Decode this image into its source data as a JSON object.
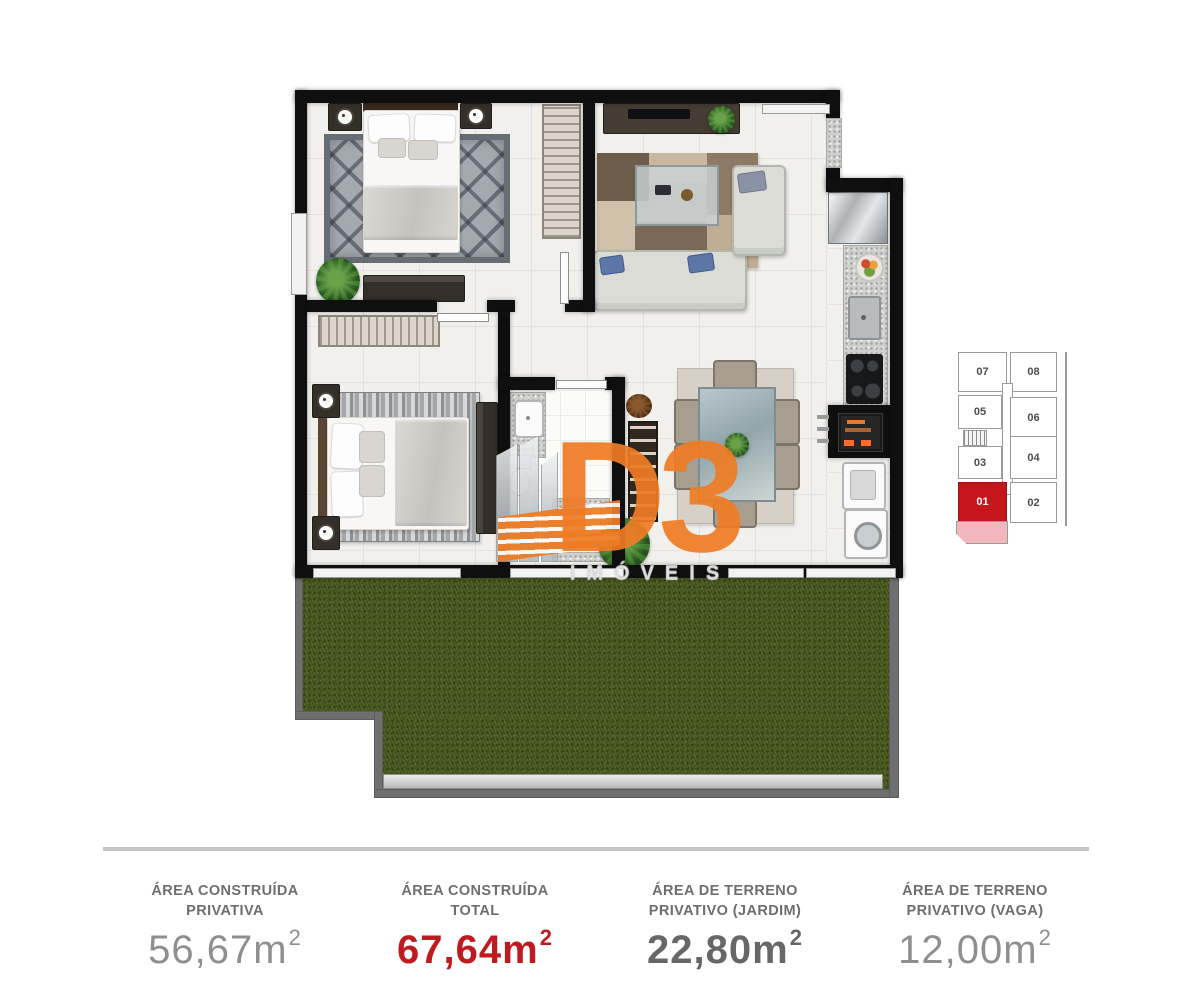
{
  "watermark": {
    "brand": "D3",
    "subtitle": "IMÓVEIS",
    "orange": "#ee7c24"
  },
  "keyplan": {
    "units": [
      {
        "label": "07",
        "highlighted": false
      },
      {
        "label": "08",
        "highlighted": false
      },
      {
        "label": "05",
        "highlighted": false
      },
      {
        "label": "06",
        "highlighted": false
      },
      {
        "label": "03",
        "highlighted": false
      },
      {
        "label": "04",
        "highlighted": false
      },
      {
        "label": "01",
        "highlighted": true
      },
      {
        "label": "02",
        "highlighted": false
      }
    ],
    "highlight_color": "#c4161c",
    "garden_highlight_color": "#f3b6bc"
  },
  "stats": [
    {
      "label1": "ÁREA CONSTRUÍDA",
      "label2": "PRIVATIVA",
      "value": "56,67",
      "unit": "m",
      "sup": "2"
    },
    {
      "label1": "ÁREA CONSTRUÍDA",
      "label2": "TOTAL",
      "value": "67,64",
      "unit": "m",
      "sup": "2"
    },
    {
      "label1": "ÁREA DE TERRENO",
      "label2": "PRIVATIVO (JARDIM)",
      "value": "22,80",
      "unit": "m",
      "sup": "2"
    },
    {
      "label1": "ÁREA DE TERRENO",
      "label2": "PRIVATIVO (VAGA)",
      "value": "12,00",
      "unit": "m",
      "sup": "2"
    }
  ],
  "colors": {
    "accent_red": "#bf1a20",
    "wall_black": "#0f0f0f",
    "grass_green": "#4b5d21",
    "fence_gray": "#6f6f6f",
    "label_gray": "#6e6e6e"
  }
}
